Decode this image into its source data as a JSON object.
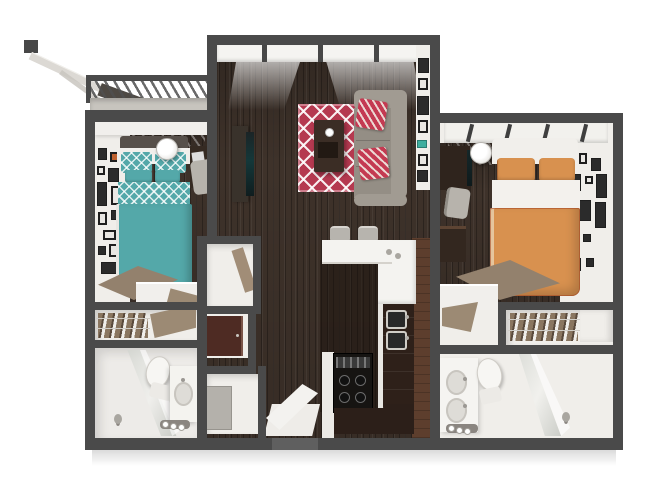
{
  "scene": {
    "description": "3D top-down dollhouse rendering of a two-bedroom / two-bathroom apartment floor plan with shared living room, open kitchen, hall closets, entry and a balcony",
    "visible_text": []
  },
  "rooms": {
    "balcony": {
      "label": "Balcony",
      "items": [
        "slatted railing",
        "leaning board",
        "bench"
      ]
    },
    "living_room": {
      "label": "Living Room",
      "items": [
        "window wall",
        "red lattice area rug",
        "coffee table",
        "gray sectional sofa",
        "red chevron throw pillows",
        "tv console",
        "wall frames"
      ]
    },
    "kitchen": {
      "label": "Kitchen",
      "items": [
        "breakfast bar",
        "two bar stools",
        "double-basin sink",
        "range with cooktop",
        "espresso cabinets"
      ]
    },
    "entry": {
      "label": "Entry",
      "items": [
        "entry door"
      ]
    },
    "hall_closets": {
      "label": "Hall Closets",
      "items": [
        "linen closet",
        "utility cabinet",
        "storage closet"
      ]
    },
    "bedroom_left": {
      "label": "Bedroom A",
      "items": [
        "teal lattice bed",
        "table lamp",
        "desk and chair",
        "gallery wall",
        "angled desk unit"
      ]
    },
    "closet_left": {
      "label": "Closet A",
      "items": [
        "shoe shelf"
      ]
    },
    "bathroom_left": {
      "label": "Bathroom A",
      "items": [
        "glass shower",
        "toilet",
        "vanity sink",
        "three vanity lights"
      ]
    },
    "bedroom_right": {
      "label": "Bedroom B",
      "items": [
        "orange bed",
        "table lamp",
        "desk with monitor",
        "dresser",
        "gallery wall"
      ]
    },
    "closet_right": {
      "label": "Closet B",
      "items": [
        "shoe shelf"
      ]
    },
    "bathroom_right": {
      "label": "Bathroom B",
      "items": [
        "glass shower",
        "toilet",
        "vanity sink",
        "three vanity lights"
      ]
    }
  },
  "colors": {
    "wall": "#4a4a4a",
    "wood": "#3e322a",
    "white_wall": "#f0eeea",
    "concrete": "#c7c4be",
    "rug_red": "#b53950",
    "pillow_red": "#c43a52",
    "sofa_gray": "#a19b92",
    "sofa_seat": "#948e85",
    "teal": "#54a8a9",
    "orange": "#d8914f",
    "espresso": "#2e2019",
    "maroon_door": "#4e2b23",
    "panel_brown": "#5d3e2d",
    "tan_desk": "#93816d",
    "tan_shelf": "#9c8a74",
    "appliance": "#161412",
    "frame_dark": "#1e1e1e",
    "accent_teal": "#3fae9f",
    "mattress_white": "#f1efeb"
  }
}
